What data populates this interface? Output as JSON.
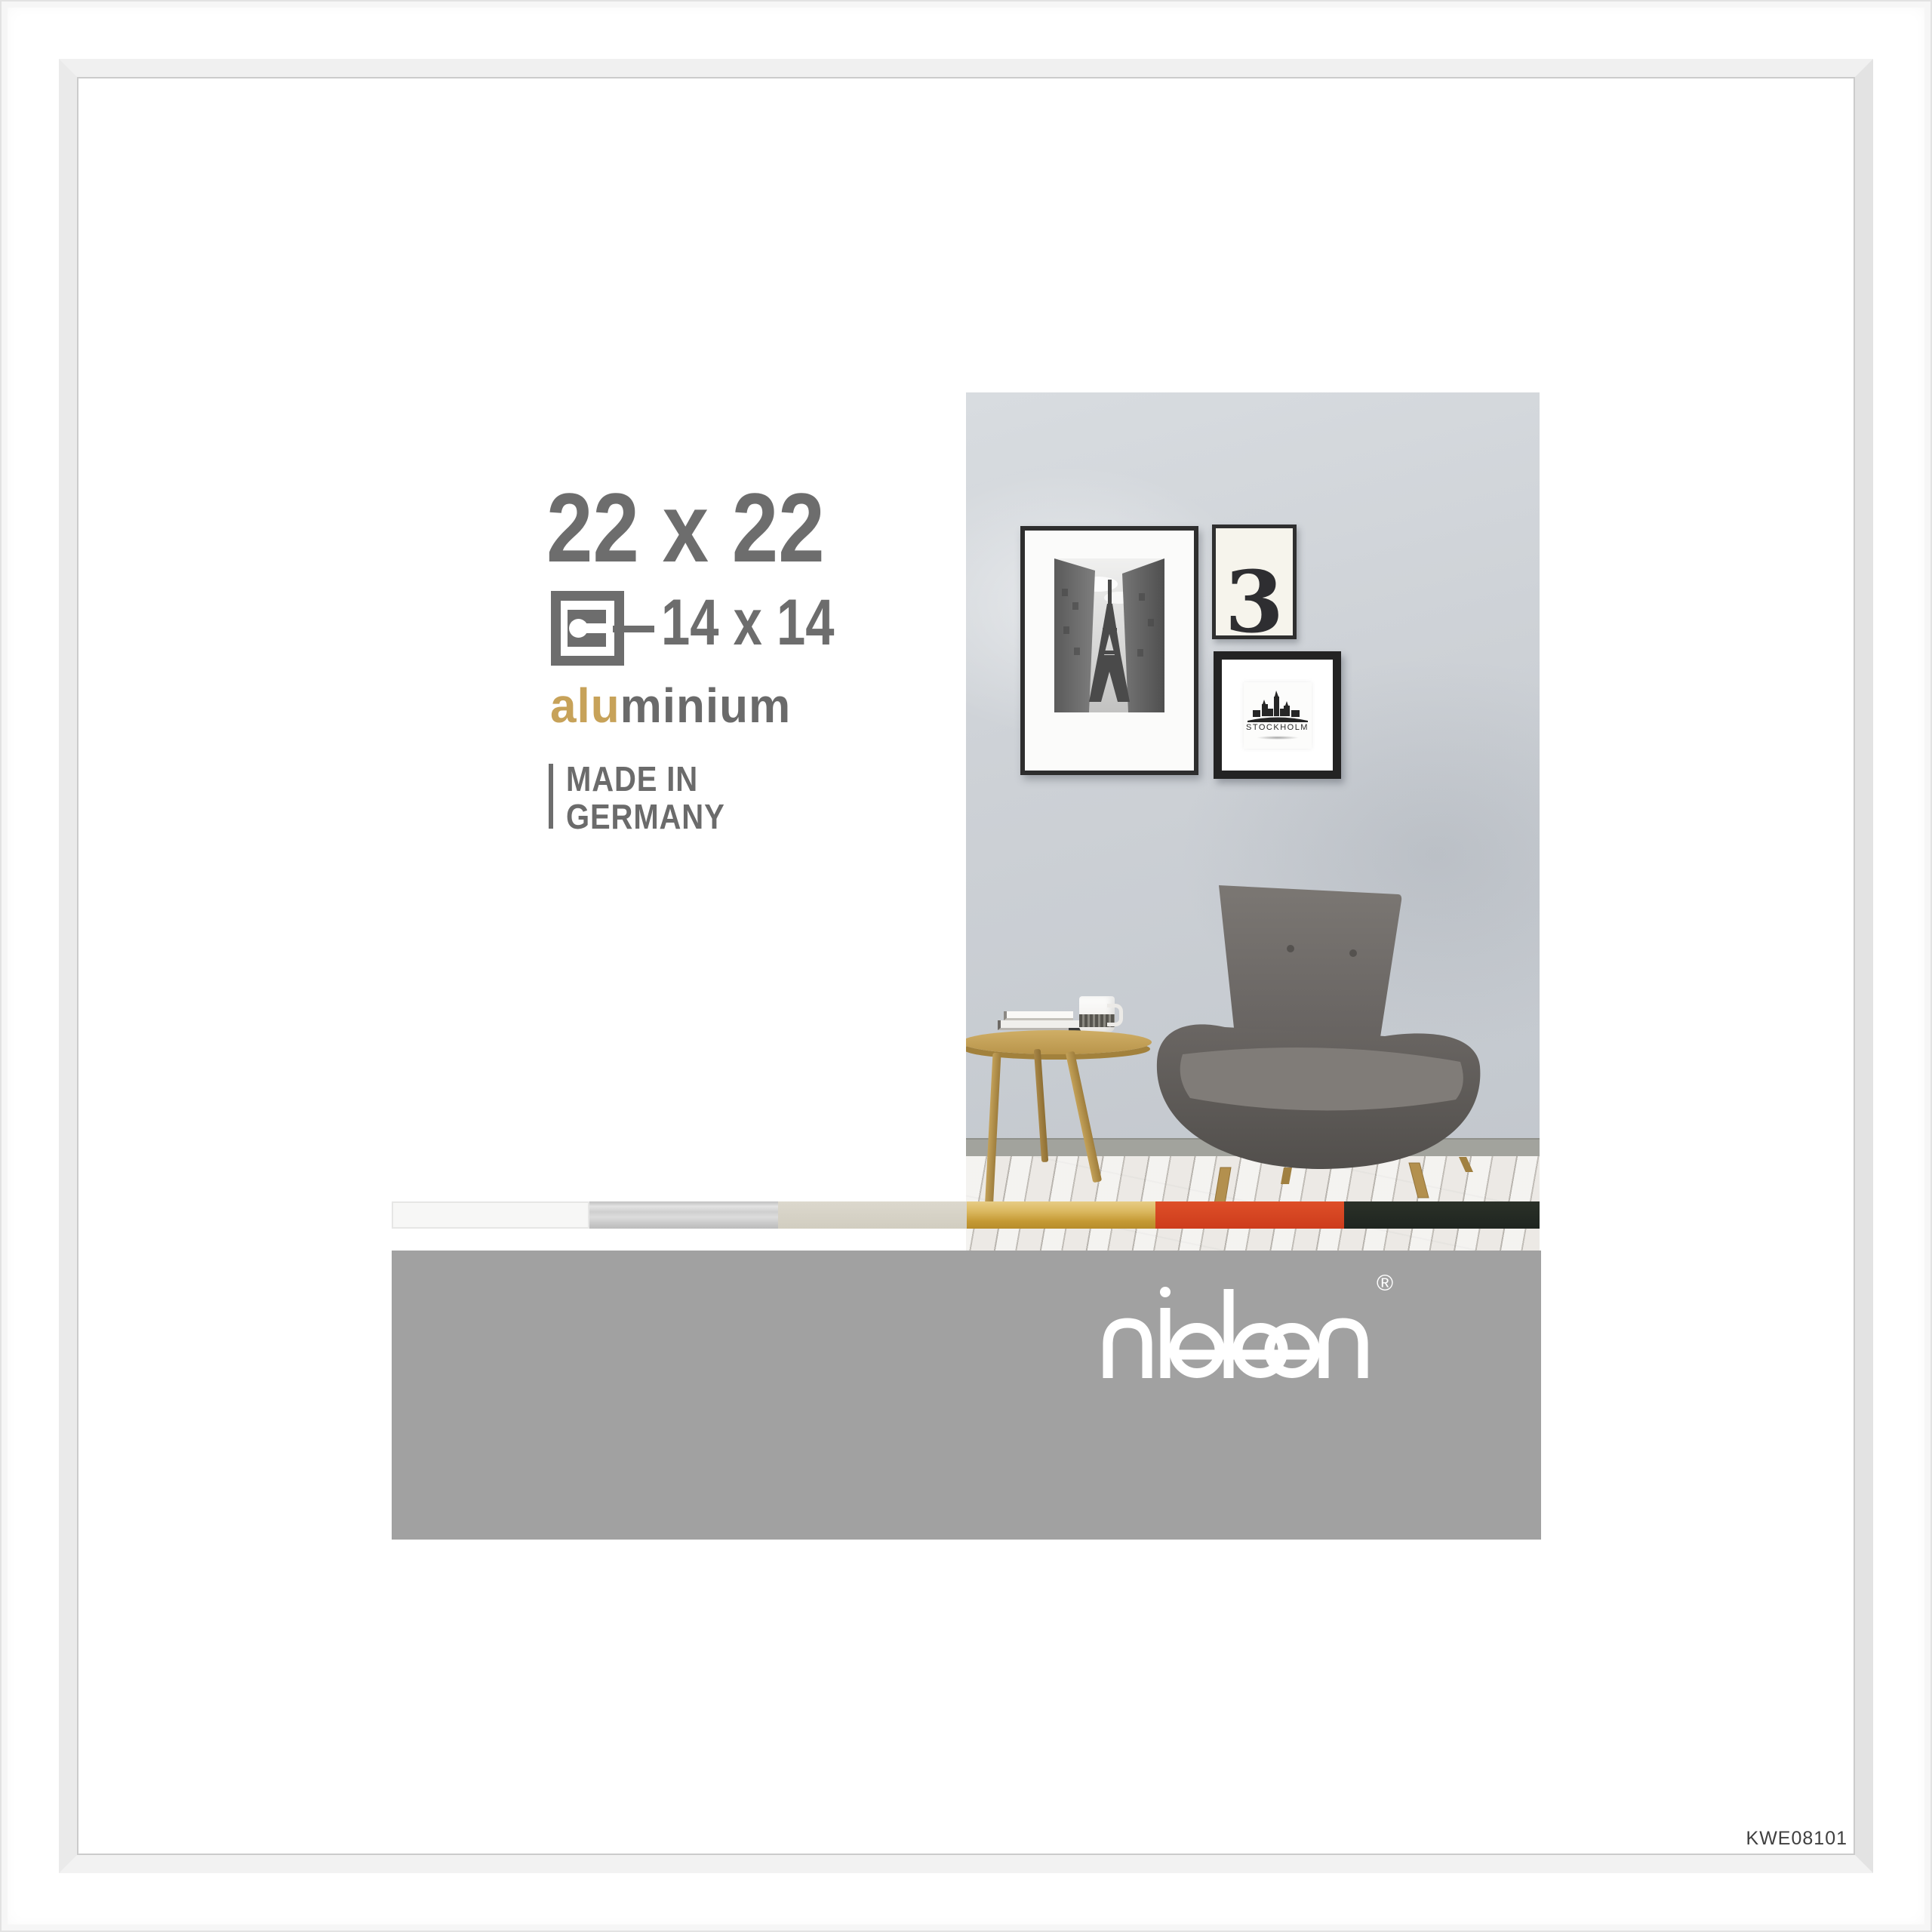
{
  "label": {
    "outer_size": "22 x 22",
    "mat_size": "14 x 14",
    "material_highlight": "alu",
    "material_rest": "minium",
    "made_in_line1": "MADE IN",
    "made_in_line2": "GERMANY"
  },
  "brand": {
    "name": "nielsen",
    "registered_mark": "®"
  },
  "sku": "KWE08101",
  "scene": {
    "poster_number": "3",
    "poster_city": "STOCKHOLM"
  },
  "swatches": [
    {
      "name": "white",
      "hex": "#f7f7f6"
    },
    {
      "name": "silver",
      "hex": "#d3d3d3"
    },
    {
      "name": "champagne",
      "hex": "#d7d3c7"
    },
    {
      "name": "gold",
      "hex": "#c9a64b"
    },
    {
      "name": "red-orange",
      "hex": "#d84522"
    },
    {
      "name": "black-green",
      "hex": "#252b23"
    }
  ],
  "colors": {
    "text_gray": "#6d6d6d",
    "accent_gold": "#c7a259",
    "banner_gray": "#a1a1a1",
    "frame_white": "#fcfcfc",
    "sku_text": "#3f3f3f"
  }
}
